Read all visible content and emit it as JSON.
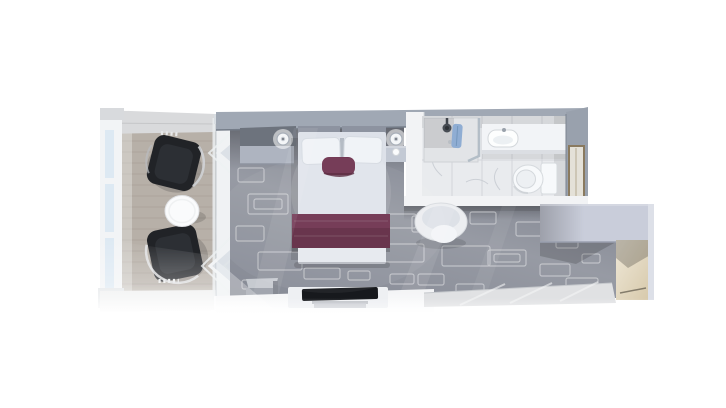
{
  "scene": {
    "kind": "3d-rendered-floorplan-top-down",
    "subject": "stateroom-with-balcony-bathroom-and-entry-hall",
    "visible_text": ""
  },
  "colors": {
    "background": "#ffffff",
    "wall_top": "#a0a8b4",
    "wall_top_light": "#d9dadc",
    "wall_white": "#f2f3f5",
    "wood_floor": "#b7b0a8",
    "wood_line": "#a49c93",
    "rail_frame": "#f2f4f6",
    "rail_glass": "#dde9f3",
    "chair_dark": "#212327",
    "chair_frame": "#d0d3d6",
    "table_white": "#fafbfc",
    "door_glass": "#c3ccd6",
    "carpet": "#868a95",
    "carpet_line": "#ffffff",
    "headboard": "#8d93a0",
    "bed_duvet": "#dde1e9",
    "pillow": "#f0f3f7",
    "plum": "#6f3350",
    "plum_dark": "#55243a",
    "nightstand": "#c3c9d4",
    "cabinet": "#aeb4c0",
    "marble": "#e9ebee",
    "grout": "#d2d5da",
    "vein": "#c8ccd2",
    "counter": "#f2f4f7",
    "fixture_white": "#f7f9fb",
    "fixture_line": "#d6dade",
    "towel_blue": "#8fadd3",
    "door_panel_fill": "#e4e1d8",
    "door_panel_frame": "#8a7a5f",
    "closet": "#c9cdda",
    "entry_beige": "#efe8d8",
    "entry_beige_dark": "#d6c8a9",
    "tile_floor": "#e0e1e3",
    "tv_black": "#17191d",
    "console_white": "#eef0f3",
    "ottoman": "#9ba0a9",
    "chair_white": "#eceef1"
  },
  "rooms": [
    {
      "name": "balcony",
      "items": [
        "glass-railing",
        "wood-plank-floor",
        "wicker-chair",
        "wicker-chair",
        "round-side-table",
        "partition-wall"
      ]
    },
    {
      "name": "bedroom",
      "items": [
        "sliding-glass-balcony-door",
        "patterned-carpet",
        "wall-cabinet",
        "wall-sconce",
        "wall-sconce",
        "double-bed",
        "white-pillow",
        "white-pillow",
        "plum-accent-pillow",
        "plum-bed-runner",
        "nightstand",
        "ottoman-stool",
        "tv-console",
        "flat-screen-tv",
        "round-desk-chair"
      ]
    },
    {
      "name": "bathroom",
      "items": [
        "marble-tile-floor",
        "walk-in-shower",
        "shower-head",
        "blue-towel",
        "vanity-counter",
        "sink",
        "toilet",
        "framed-door-panel"
      ]
    },
    {
      "name": "entry-hall",
      "items": [
        "wardrobe-closet",
        "entry-door-wall",
        "light-tile-floor"
      ]
    }
  ]
}
